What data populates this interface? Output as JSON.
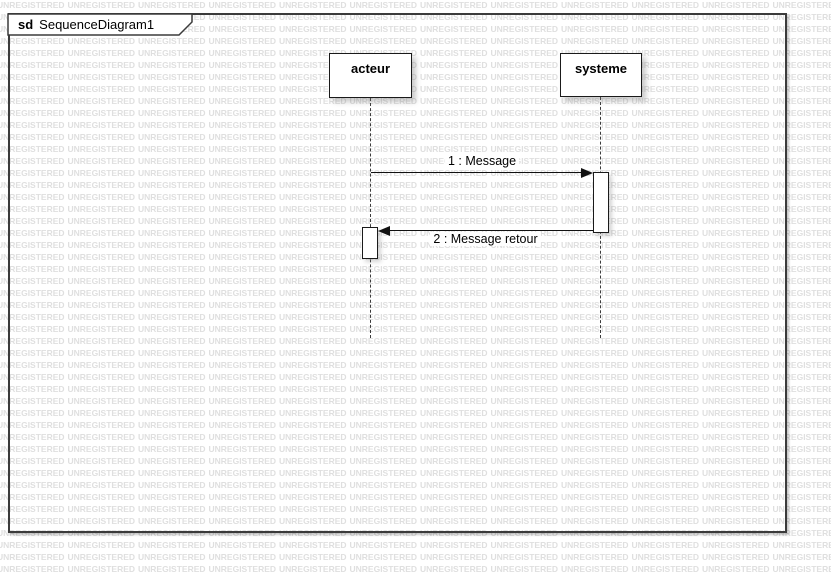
{
  "frame": {
    "type_label": "sd",
    "title": "SequenceDiagram1"
  },
  "lifelines": [
    {
      "name": "acteur"
    },
    {
      "name": "systeme"
    }
  ],
  "messages": [
    {
      "label": "1 : Message",
      "from": "acteur",
      "to": "systeme",
      "direction": "right"
    },
    {
      "label": "2 : Message retour",
      "from": "systeme",
      "to": "acteur",
      "direction": "left"
    }
  ],
  "watermark": {
    "text": "UNREGISTERED",
    "color": "#dfdfdf"
  },
  "colors": {
    "background": "#ffffff",
    "frame_border": "#3b3b3b",
    "shape_border": "#1a1a1a",
    "message_line": "#111111"
  }
}
